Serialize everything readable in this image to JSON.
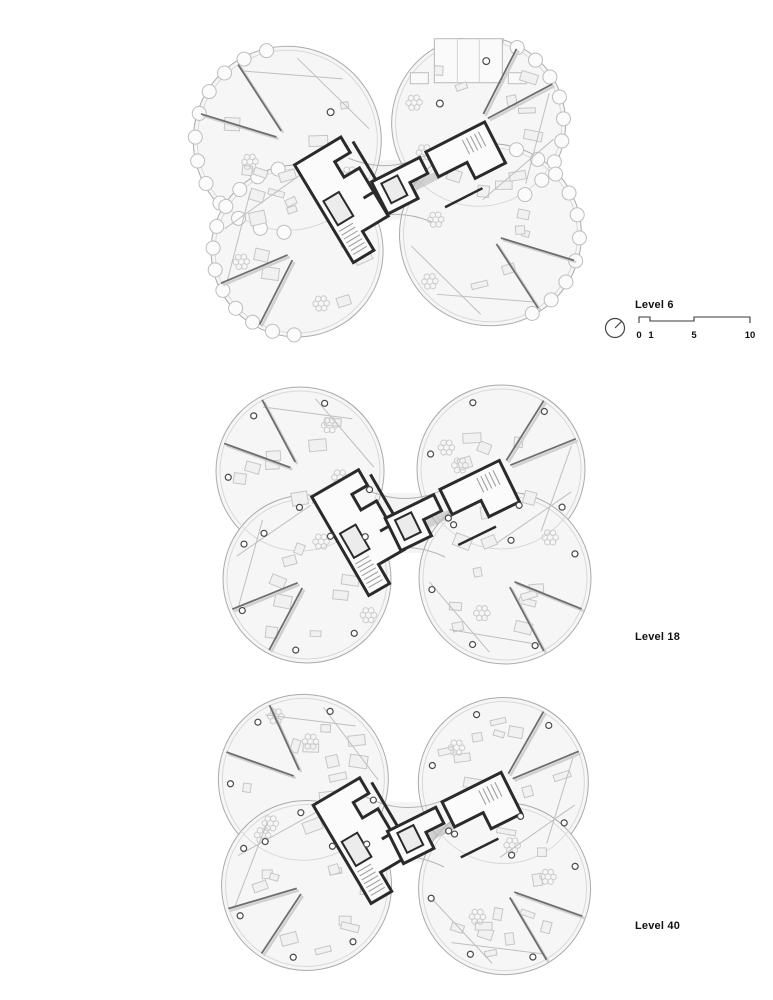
{
  "document": {
    "type": "architectural floor plan sheet",
    "background": "#ffffff"
  },
  "plans": [
    {
      "id": "level-6",
      "label": "Level 6"
    },
    {
      "id": "level-18",
      "label": "Level 18"
    },
    {
      "id": "level-40",
      "label": "Level 40"
    }
  ],
  "legend": {
    "north_arrow_icon": "compass-circle-with-needle",
    "scale_bar": {
      "ticks": [
        "0",
        "1",
        "5",
        "10"
      ]
    }
  },
  "colors": {
    "wall": "#2a2a2a",
    "facade_outline": "#ababab",
    "floor_fill": "#f6f6f6",
    "furniture_line": "#c6c6c6",
    "partition": "#6e6e6e",
    "text": "#111111"
  }
}
